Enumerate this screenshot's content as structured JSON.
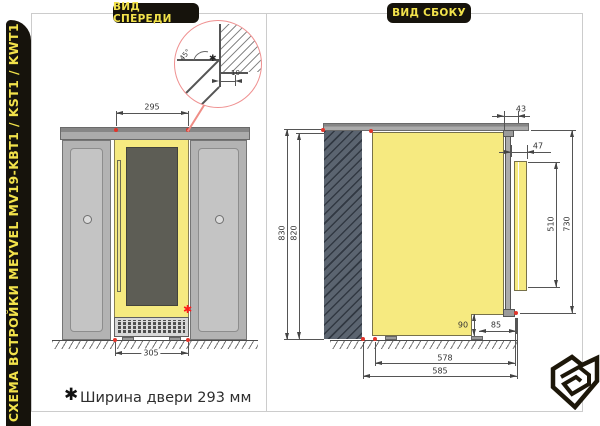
{
  "sidebar": {
    "title": "СХЕМА ВСТРОЙКИ MEYVEL MV19-KBT1 / KST1 / KWT1"
  },
  "tabs": {
    "front": "ВИД СПЕРЕДИ",
    "side": "ВИД СБОКУ"
  },
  "detail_callout": {
    "angle_label": "45°",
    "gap_label": "10",
    "marker": "✱"
  },
  "front_view": {
    "dims": {
      "niche_width": "295",
      "bottom_width": "305"
    },
    "star_marker": "✱"
  },
  "side_view": {
    "dims": {
      "total_height": "830",
      "niche_height": "820",
      "top_inset": "43",
      "door_clearance": "47",
      "door_panel_height": "510",
      "door_height": "730",
      "plinth_height": "90",
      "plinth_depth": "85",
      "body_depth": "578",
      "total_depth": "585"
    }
  },
  "footnote": {
    "marker": "✱",
    "text": "Ширина двери 293 мм"
  },
  "colors": {
    "accent_yellow": "#F6EA80",
    "label_yellow": "#F2E24B",
    "panel_black": "#16130C",
    "marker_red": "#E2352B",
    "callout_pink": "#EF9090",
    "wall_slate": "#5B6470"
  }
}
